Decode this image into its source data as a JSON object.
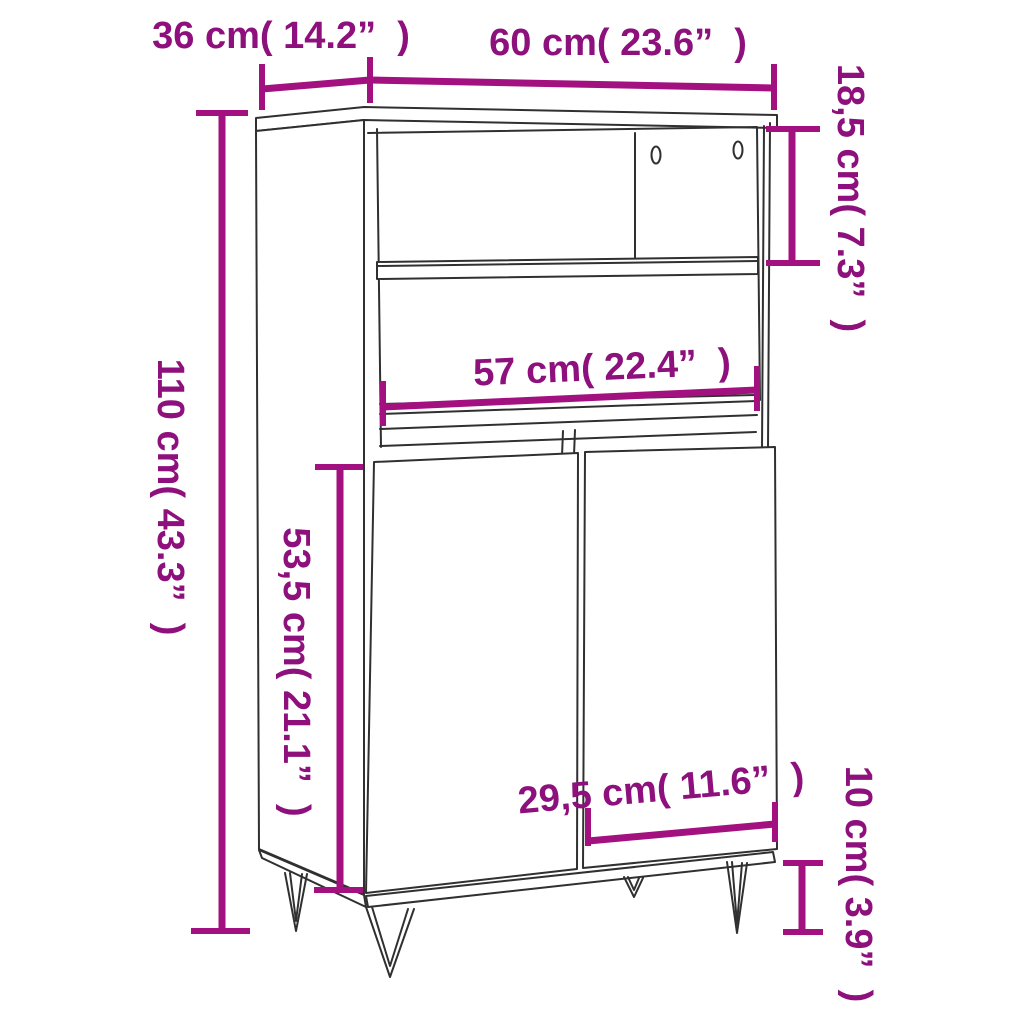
{
  "diagram": {
    "kind": "furniture-dimension-diagram",
    "product": "highboard cabinet with open shelves, two doors and hairpin legs",
    "colors": {
      "background": "#ffffff",
      "label_text": "#8d107c",
      "dimension_lines": "#a2117f",
      "drawing_lines": "#303030"
    },
    "dimensions": [
      {
        "id": "depth",
        "cm": "36",
        "inches": "14.2",
        "label": "36 cm( 14.2”  )",
        "orientation": "horizontal"
      },
      {
        "id": "width",
        "cm": "60",
        "inches": "23.6",
        "label": "60 cm( 23.6”  )",
        "orientation": "horizontal"
      },
      {
        "id": "top-section-height",
        "cm": "18,5",
        "inches": "7.3",
        "label": "18,5 cm( 7.3”  )",
        "orientation": "vertical"
      },
      {
        "id": "total-height",
        "cm": "110",
        "inches": "43.3",
        "label": "110 cm( 43.3”  )",
        "orientation": "vertical"
      },
      {
        "id": "inner-width",
        "cm": "57",
        "inches": "22.4",
        "label": "57 cm( 22.4”  )",
        "orientation": "horizontal"
      },
      {
        "id": "door-height",
        "cm": "53,5",
        "inches": "21.1",
        "label": "53,5 cm( 21.1”  )",
        "orientation": "vertical"
      },
      {
        "id": "door-width",
        "cm": "29,5",
        "inches": "11.6",
        "label": "29,5 cm( 11.6”  )",
        "orientation": "horizontal"
      },
      {
        "id": "leg-height",
        "cm": "10",
        "inches": "3.9",
        "label": "10 cm( 3.9”  )",
        "orientation": "vertical"
      }
    ]
  }
}
